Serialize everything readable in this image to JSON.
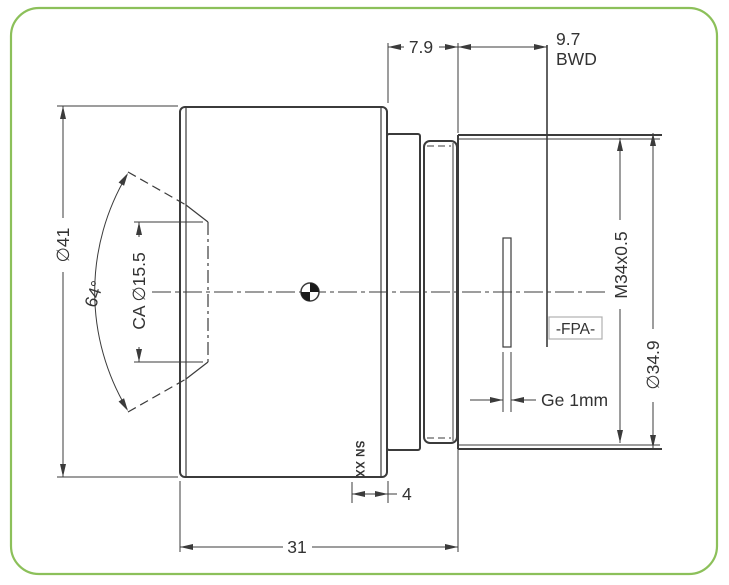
{
  "drawing": {
    "type": "lens mechanical cross-section drawing",
    "colors": {
      "border": "#8cc05a",
      "line": "#3b3b3b",
      "text": "#333333",
      "background": "#ffffff",
      "fpa_box_border": "#b0b0b0"
    },
    "labels": {
      "front_diameter": "∅41",
      "fov_angle": "64°",
      "clear_aperture": "CA ∅15.5",
      "flange_offset": "7.9",
      "bwd_value": "9.7",
      "bwd_label": "BWD",
      "thread": "M34x0.5",
      "rear_diameter": "∅34.9",
      "fpa": "-FPA-",
      "window": "Ge 1mm",
      "serial_marking": "SN XX",
      "marking_band_width": "4",
      "body_length": "31"
    }
  }
}
